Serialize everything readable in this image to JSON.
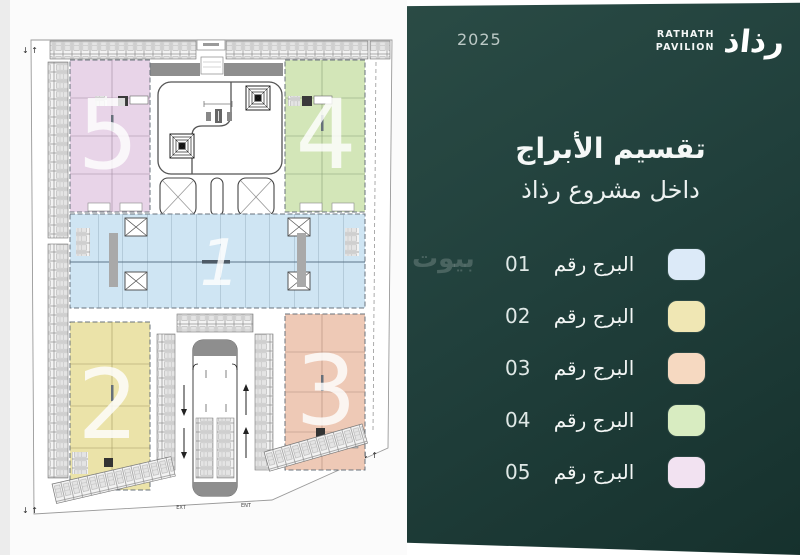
{
  "panel": {
    "year": "2025",
    "brand": {
      "line1": "RATHATH",
      "line2": "PAVILION",
      "mark": "رذاذ"
    },
    "title_line1": "تقسيم الأبراج",
    "title_line2": "داخل مشروع رذاذ",
    "legend": [
      {
        "number": "01",
        "label": "البرج رقم",
        "color": "#dceaf8"
      },
      {
        "number": "02",
        "label": "البرج رقم",
        "color": "#f0e7b4"
      },
      {
        "number": "03",
        "label": "البرج رقم",
        "color": "#f6d9c1"
      },
      {
        "number": "04",
        "label": "البرج رقم",
        "color": "#d8ecc1"
      },
      {
        "number": "05",
        "label": "البرج رقم",
        "color": "#f2e2f1"
      }
    ],
    "background": "#21403c",
    "watermark": "بيوت"
  },
  "plan": {
    "towers": [
      {
        "number": "1",
        "color": "#cfe5f3"
      },
      {
        "number": "2",
        "color": "#ebe3a9"
      },
      {
        "number": "3",
        "color": "#eec9b6"
      },
      {
        "number": "4",
        "color": "#d3e6b8"
      },
      {
        "number": "5",
        "color": "#e8d4e8"
      }
    ],
    "garage": {
      "exit_label": "EXT",
      "entry_label": "ENT"
    },
    "corner_arrows": "↓ ↑"
  }
}
